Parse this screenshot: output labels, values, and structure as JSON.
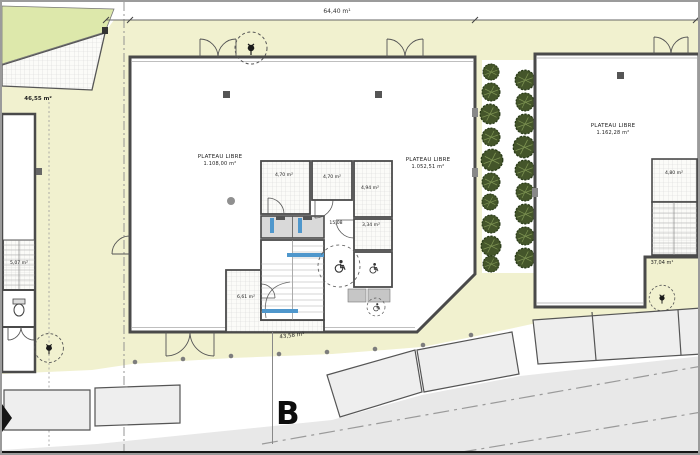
{
  "drawing": {
    "section_marker": "B",
    "dimensions": {
      "top": "64,40 m¹",
      "bottom": "43,58 m¹",
      "right": "37,04 m¹"
    },
    "areas": {
      "terrace": "46,55 m²",
      "plateau_left": {
        "label": "PLATEAU LIBRE"
      },
      "plateau_mid_west": {
        "label": "PLATEAU LIBRE",
        "area": "1.108,00 m²"
      },
      "plateau_mid_east": {
        "label": "PLATEAU LIBRE",
        "area": "1.052,51 m²"
      },
      "plateau_right": {
        "label": "PLATEAU LIBRE",
        "area": "1.162,28 m²"
      },
      "rooms": {
        "room_a": "4,70 m²",
        "room_b": "4,70 m²",
        "room_c": "4,94 m²",
        "room_d": "3,34 m²",
        "lobby": "15,08",
        "room_e": "6,61 m²",
        "stair_left": "5,07 m²",
        "stair_right": "4,80 m²"
      }
    },
    "icons": [
      "tree-marker-icon",
      "wheelchair-icon",
      "toilet-icon",
      "bush-icon"
    ],
    "colors": {
      "site_yellow": "#f1f1cf",
      "lawn_green": "#dde8ab",
      "wall_gray": "#4a4a4a",
      "road_gray": "#e8e8e8",
      "parking_fill": "#eeeeee",
      "tree_green": "#44552a",
      "accent_blue": "#4f97cc",
      "hatch_line": "#d8d8d8"
    }
  }
}
